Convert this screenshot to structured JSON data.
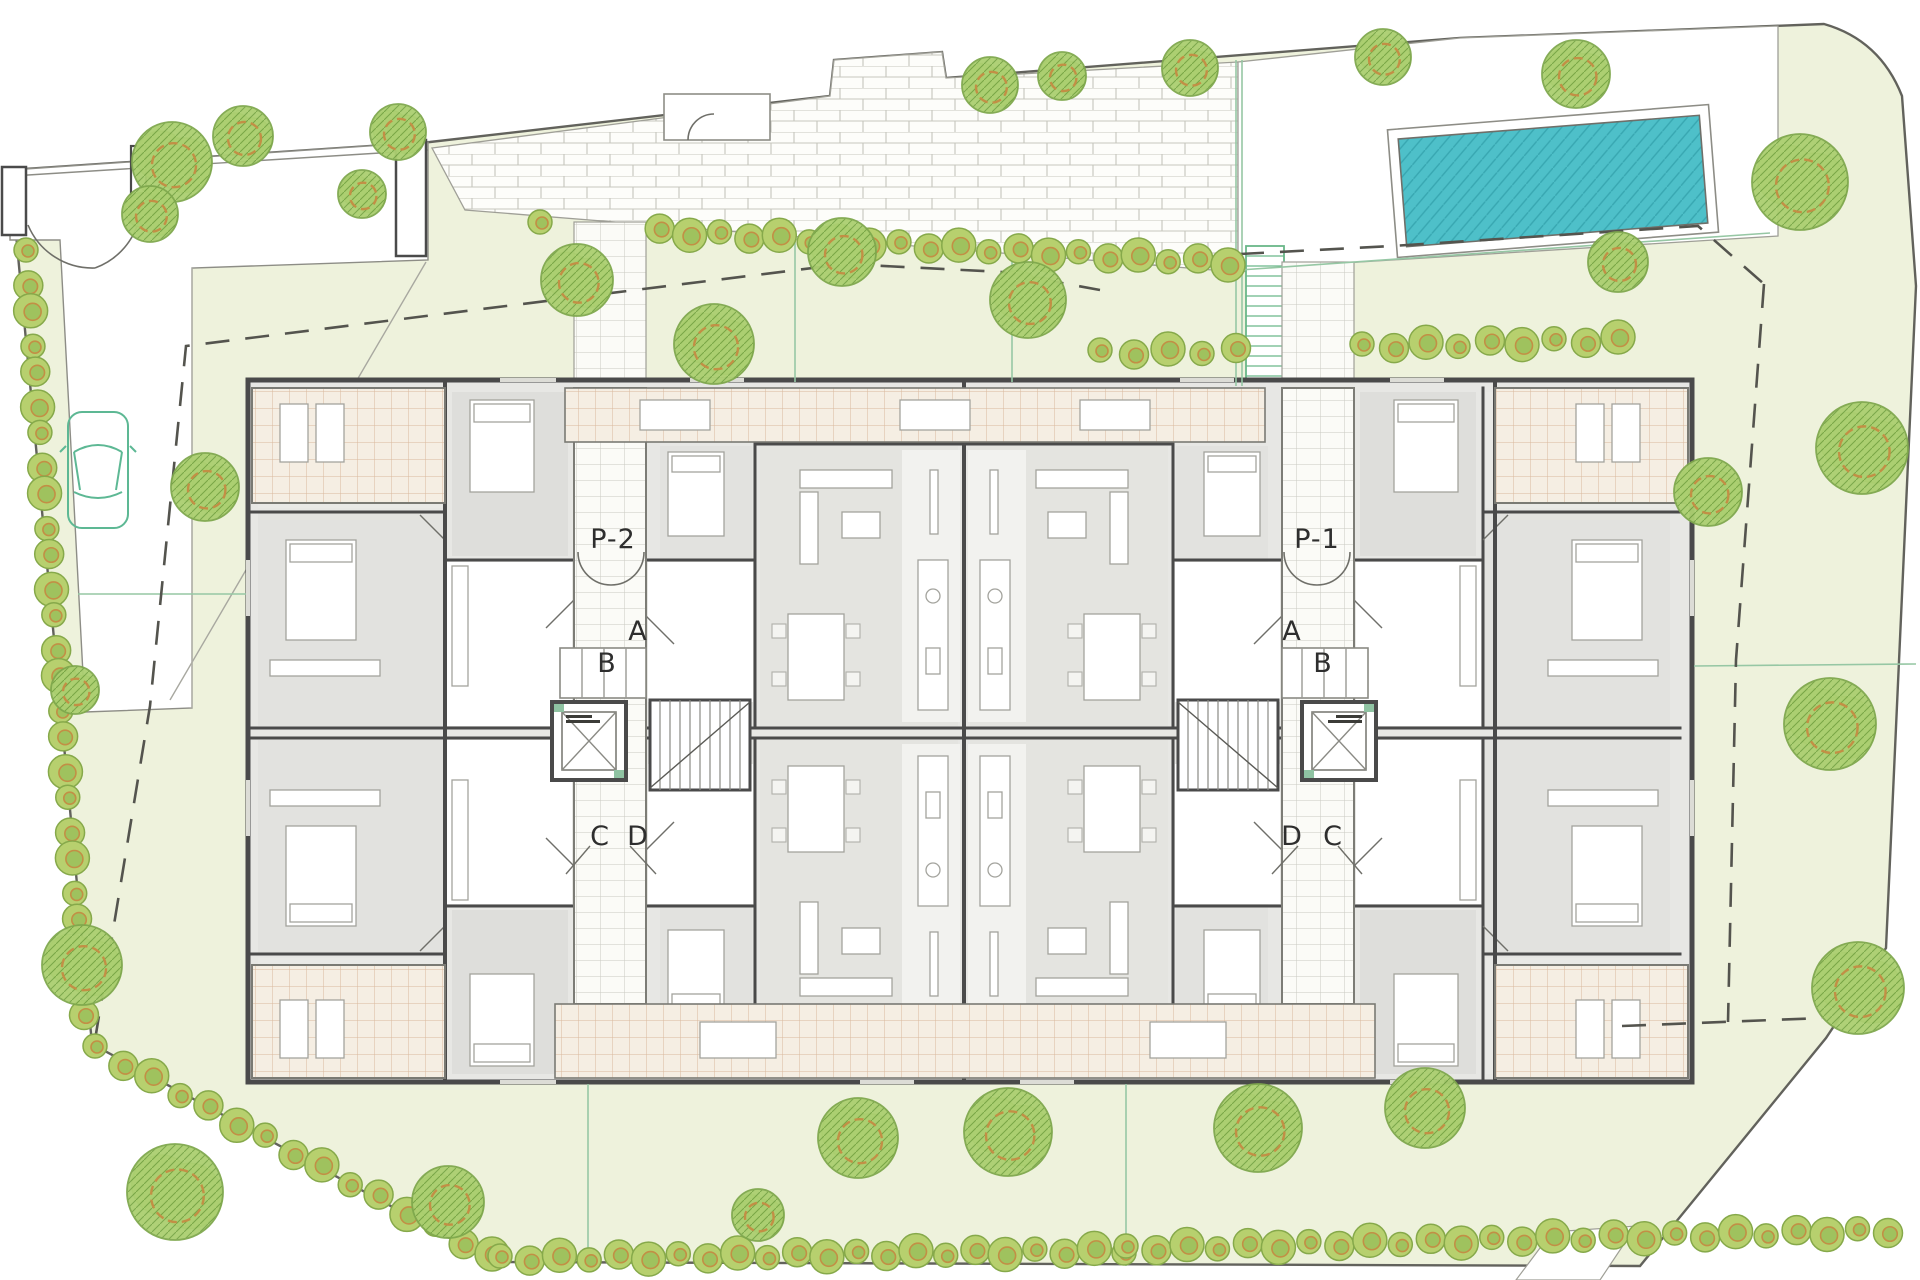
{
  "title": "Residential complex ground floor site plan",
  "labels": {
    "left": {
      "p": "P-2",
      "a": "A",
      "b": "B",
      "c": "C",
      "d": "D"
    },
    "right": {
      "p": "P-1",
      "a": "A",
      "b": "B",
      "c": "C",
      "d": "D"
    }
  },
  "colors": {
    "lawn": "#eef2dc",
    "paving": "#fdfdfa",
    "paving_joint": "#c6c6bd",
    "wall": "#4a4a4a",
    "room": "#e4e4e1",
    "terrace_bg": "#f5eee3",
    "terrace_grid": "#d9b89c",
    "pool_water": "#4ec0c9",
    "pool_hatch": "#38a7b1",
    "tree_fill": "#b9d47c",
    "tree_ring": "#c28f45",
    "tree_line": "#7fa84d",
    "setback_dash": "#54544e",
    "guide_green": "#96c7a4",
    "car_outline": "#5db894"
  },
  "landscape": {
    "trees": [
      {
        "x": 172,
        "y": 162,
        "r": 40
      },
      {
        "x": 243,
        "y": 136,
        "r": 30
      },
      {
        "x": 150,
        "y": 214,
        "r": 28
      },
      {
        "x": 398,
        "y": 132,
        "r": 28
      },
      {
        "x": 362,
        "y": 194,
        "r": 24
      },
      {
        "x": 577,
        "y": 280,
        "r": 36
      },
      {
        "x": 714,
        "y": 344,
        "r": 40
      },
      {
        "x": 842,
        "y": 252,
        "r": 34
      },
      {
        "x": 1028,
        "y": 300,
        "r": 38
      },
      {
        "x": 990,
        "y": 85,
        "r": 28
      },
      {
        "x": 1062,
        "y": 76,
        "r": 24
      },
      {
        "x": 1190,
        "y": 68,
        "r": 28
      },
      {
        "x": 1383,
        "y": 57,
        "r": 28
      },
      {
        "x": 1576,
        "y": 74,
        "r": 34
      },
      {
        "x": 1800,
        "y": 182,
        "r": 48
      },
      {
        "x": 1618,
        "y": 262,
        "r": 30
      },
      {
        "x": 1862,
        "y": 448,
        "r": 46
      },
      {
        "x": 1708,
        "y": 492,
        "r": 34
      },
      {
        "x": 1830,
        "y": 724,
        "r": 46
      },
      {
        "x": 1858,
        "y": 988,
        "r": 46
      },
      {
        "x": 205,
        "y": 487,
        "r": 34
      },
      {
        "x": 75,
        "y": 690,
        "r": 24
      },
      {
        "x": 82,
        "y": 965,
        "r": 40
      },
      {
        "x": 175,
        "y": 1192,
        "r": 48
      },
      {
        "x": 448,
        "y": 1202,
        "r": 36
      },
      {
        "x": 758,
        "y": 1215,
        "r": 26
      },
      {
        "x": 858,
        "y": 1138,
        "r": 40
      },
      {
        "x": 1008,
        "y": 1132,
        "r": 44
      },
      {
        "x": 1258,
        "y": 1128,
        "r": 44
      },
      {
        "x": 1425,
        "y": 1108,
        "r": 40
      }
    ],
    "hedges": [
      {
        "x1": 26,
        "y1": 252,
        "x2": 84,
        "y2": 1012,
        "n": 26,
        "gaps": []
      },
      {
        "x1": 540,
        "y1": 224,
        "x2": 1228,
        "y2": 262,
        "n": 24,
        "gaps": [
          [
            564,
            656
          ]
        ]
      },
      {
        "x1": 1100,
        "y1": 352,
        "x2": 1236,
        "y2": 350,
        "n": 5,
        "gaps": []
      },
      {
        "x1": 1362,
        "y1": 346,
        "x2": 1618,
        "y2": 339,
        "n": 9,
        "gaps": []
      },
      {
        "x1": 95,
        "y1": 1048,
        "x2": 492,
        "y2": 1256,
        "n": 15,
        "gaps": []
      },
      {
        "x1": 500,
        "y1": 1258,
        "x2": 1124,
        "y2": 1250,
        "n": 22,
        "gaps": []
      },
      {
        "x1": 1126,
        "y1": 1248,
        "x2": 1888,
        "y2": 1230,
        "n": 26,
        "gaps": []
      }
    ],
    "dashed": [
      {
        "points": "95,1040 150,706 186,346 482,309 845,264 1002,272 1100,290"
      },
      {
        "points": "1240,254 1392,246 1698,226 1764,284"
      },
      {
        "points": "1764,284 1736,660 1728,1022"
      },
      {
        "points": "1622,1026 1822,1018"
      }
    ],
    "guides": [
      {
        "x1": 78,
        "y1": 594,
        "x2": 246,
        "y2": 594
      },
      {
        "x1": 1694,
        "y1": 666,
        "x2": 1916,
        "y2": 664
      },
      {
        "x1": 1236,
        "y1": 60,
        "x2": 1236,
        "y2": 386
      },
      {
        "x1": 1242,
        "y1": 60,
        "x2": 1242,
        "y2": 386
      },
      {
        "x1": 795,
        "y1": 238,
        "x2": 795,
        "y2": 382
      },
      {
        "x1": 1012,
        "y1": 242,
        "x2": 1012,
        "y2": 382
      },
      {
        "x1": 1126,
        "y1": 1084,
        "x2": 1126,
        "y2": 1266
      },
      {
        "x1": 588,
        "y1": 1084,
        "x2": 588,
        "y2": 1270
      },
      {
        "x1": 1240,
        "y1": 270,
        "x2": 1770,
        "y2": 233
      }
    ]
  }
}
